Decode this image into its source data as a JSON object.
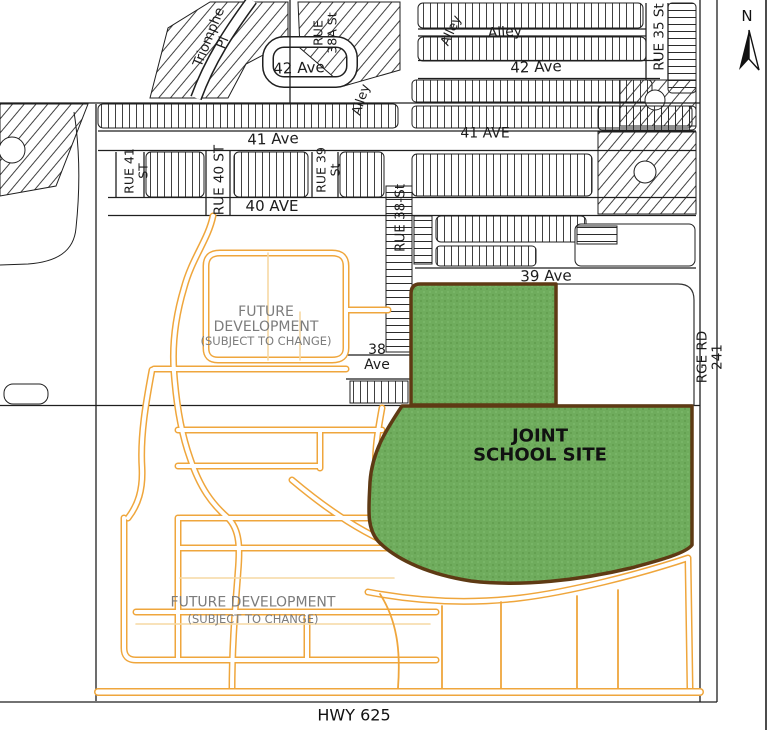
{
  "map": {
    "title_note": "subdivision plan with joint school site",
    "school_site": "JOINT SCHOOL SITE",
    "colors": {
      "site_green": "#6FAC5D",
      "site_border_brown": "#5E3A14",
      "future_road_orange": "#EFA63C",
      "future_road_pale": "#F6D9A4",
      "linework_black": "#1F1F1F",
      "muted_text_grey": "#7C7C7C"
    }
  },
  "north_arrow": {
    "label": "N"
  },
  "labels": [
    {
      "name": "street-triomphe-pl",
      "text": "Triomphe\nPl",
      "x": 216,
      "y": 40,
      "rot": -68,
      "size": 13.5,
      "weight": 400,
      "color": "#1c1c1c"
    },
    {
      "name": "street-rue-38a-st",
      "text": "RUE\n38A St",
      "x": 325,
      "y": 33,
      "rot": -90,
      "size": 12.5,
      "weight": 400,
      "color": "#1c1c1c"
    },
    {
      "name": "street-42-ave-west",
      "text": "42 Ave",
      "x": 299,
      "y": 68,
      "rot": -2,
      "size": 15,
      "weight": 400,
      "color": "#1c1c1c"
    },
    {
      "name": "alley-northwest",
      "text": "Alley",
      "x": 362,
      "y": 100,
      "rot": -72,
      "size": 13,
      "weight": 400,
      "color": "#1c1c1c"
    },
    {
      "name": "alley-north-slanted",
      "text": "Alley",
      "x": 452,
      "y": 31,
      "rot": -65,
      "size": 13,
      "weight": 400,
      "color": "#1c1c1c"
    },
    {
      "name": "alley-north",
      "text": "Alley",
      "x": 505,
      "y": 33,
      "rot": -4,
      "size": 14,
      "weight": 400,
      "color": "#1c1c1c"
    },
    {
      "name": "street-42-ave-east",
      "text": "42 Ave",
      "x": 536,
      "y": 67,
      "rot": -2,
      "size": 15,
      "weight": 400,
      "color": "#1c1c1c"
    },
    {
      "name": "street-rue-35-st",
      "text": "RUE 35 St",
      "x": 660,
      "y": 37,
      "rot": -90,
      "size": 13.5,
      "weight": 400,
      "color": "#1c1c1c"
    },
    {
      "name": "street-41-ave-west",
      "text": "41 Ave",
      "x": 273,
      "y": 139,
      "rot": -2,
      "size": 15,
      "weight": 400,
      "color": "#1c1c1c"
    },
    {
      "name": "street-41-ave-east",
      "text": "41 AVE",
      "x": 485,
      "y": 134,
      "rot": 0,
      "size": 14,
      "weight": 400,
      "color": "#1c1c1c"
    },
    {
      "name": "street-rue-41-st",
      "text": "RUE 41\nST",
      "x": 136,
      "y": 171,
      "rot": -90,
      "size": 12.5,
      "weight": 400,
      "color": "#1c1c1c"
    },
    {
      "name": "street-rue-40-st",
      "text": "RUE 40 ST",
      "x": 220,
      "y": 180,
      "rot": -90,
      "size": 13.5,
      "weight": 400,
      "color": "#1c1c1c"
    },
    {
      "name": "street-rue-39-st",
      "text": "RUE 39\nSt",
      "x": 328,
      "y": 170,
      "rot": -90,
      "size": 12.5,
      "weight": 400,
      "color": "#1c1c1c"
    },
    {
      "name": "street-40-ave",
      "text": "40 AVE",
      "x": 272,
      "y": 206,
      "rot": 0,
      "size": 15,
      "weight": 400,
      "color": "#1c1c1c"
    },
    {
      "name": "street-rue-38-st",
      "text": "RUE 38-St",
      "x": 401,
      "y": 218,
      "rot": -90,
      "size": 13.5,
      "weight": 400,
      "color": "#1c1c1c"
    },
    {
      "name": "street-39-ave",
      "text": "39 Ave",
      "x": 546,
      "y": 276,
      "rot": -1,
      "size": 15,
      "weight": 400,
      "color": "#1c1c1c"
    },
    {
      "name": "future-development-north",
      "text": "FUTURE\nDEVELOPMENT",
      "x": 266,
      "y": 320,
      "rot": 0,
      "size": 14,
      "weight": 400,
      "color": "#7c7c7c"
    },
    {
      "name": "future-development-north-note",
      "text": "(SUBJECT TO CHANGE)",
      "x": 266,
      "y": 341,
      "rot": 0,
      "size": 11.5,
      "weight": 400,
      "color": "#7c7c7c"
    },
    {
      "name": "street-38-ave",
      "text": "38\nAve",
      "x": 377,
      "y": 358,
      "rot": 0,
      "size": 14,
      "weight": 400,
      "color": "#1c1c1c"
    },
    {
      "name": "joint-school-site-label",
      "text": "JOINT\nSCHOOL SITE",
      "x": 540,
      "y": 446,
      "rot": 0,
      "size": 18,
      "weight": 700,
      "color": "#111111"
    },
    {
      "name": "road-rge-rd-241",
      "text": "RGE RD 241",
      "x": 710,
      "y": 357,
      "rot": -90,
      "size": 13.5,
      "weight": 400,
      "color": "#1c1c1c"
    },
    {
      "name": "future-development-south",
      "text": "FUTURE DEVELOPMENT",
      "x": 253,
      "y": 603,
      "rot": 0,
      "size": 14,
      "weight": 400,
      "color": "#7c7c7c"
    },
    {
      "name": "future-development-south-note",
      "text": "(SUBJECT TO CHANGE)",
      "x": 253,
      "y": 619,
      "rot": 0,
      "size": 11.5,
      "weight": 400,
      "color": "#7c7c7c"
    },
    {
      "name": "road-hwy-625",
      "text": "HWY 625",
      "x": 354,
      "y": 715,
      "rot": 0,
      "size": 16,
      "weight": 400,
      "color": "#111111"
    },
    {
      "name": "north-arrow-label",
      "text": "N",
      "x": 747,
      "y": 16,
      "rot": 0,
      "size": 15,
      "weight": 400,
      "color": "#111111"
    }
  ]
}
